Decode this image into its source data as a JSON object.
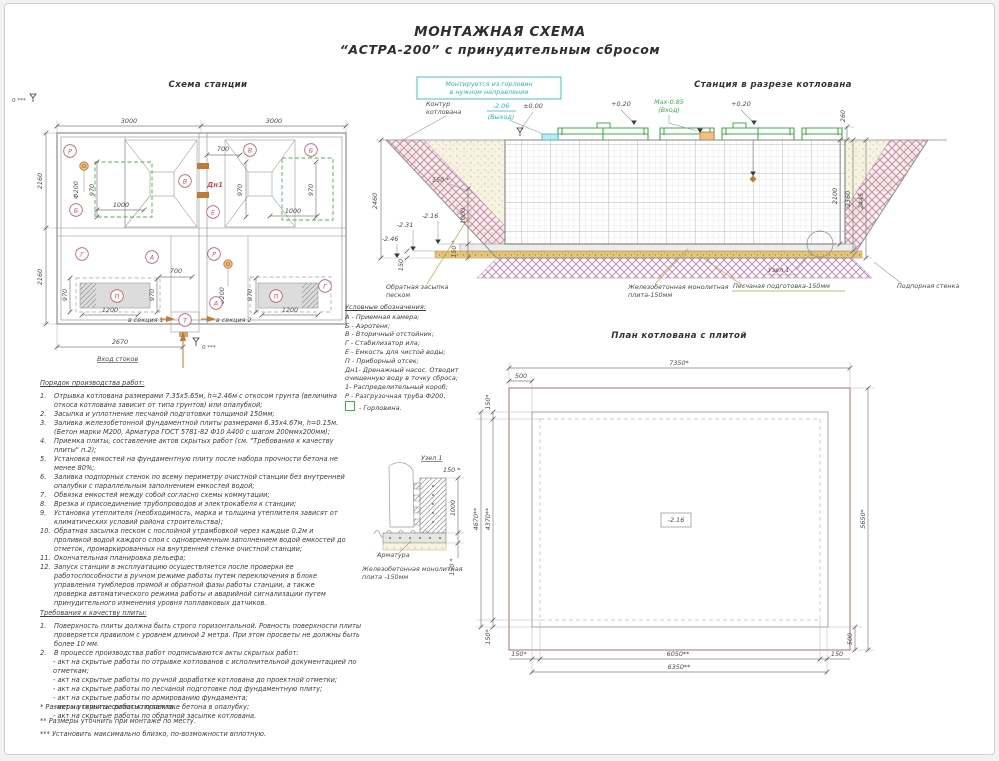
{
  "title": {
    "line1": "МОНТАЖНАЯ СХЕМА",
    "line2": "“АСТРА-200” с принудительным сбросом"
  },
  "scheme": {
    "title": "Схема станции",
    "d3000": "3000",
    "d2160": "2160",
    "d700": "700",
    "d970": "970",
    "d1000": "1000",
    "d1200": "1200",
    "d2670": "2670",
    "phi200": "Ф200",
    "zero": "0 ***",
    "dn1": "Дн1",
    "inlet": "Вход стоков",
    "sec1": "в секция 1",
    "sec2": "в секция 2",
    "L": {
      "r": "Р",
      "b": "Б",
      "v": "В",
      "e": "Е",
      "g": "Г",
      "a": "А",
      "p": "П",
      "t": "Т"
    }
  },
  "cross": {
    "title": "Станция в разрезе котлована",
    "mount1": "Монтируется из горловин",
    "mount2": "в нужном направлении",
    "contour1": "Контур",
    "contour2": "котлована",
    "out1": "-2.06",
    "out2": "(Выход)",
    "zero": "±0.00",
    "p020": "+0.20",
    "max1": "Мах-0.85",
    "max2": "(Вход)",
    "d260": "260",
    "d2445": "2445",
    "d2360": "2360",
    "d2100": "2100",
    "d2460": "2460",
    "e216": "-2.16",
    "e231": "-2.31",
    "e246": "-2.46",
    "d150s": "150 *",
    "d150": "150",
    "d1000": "1000",
    "backfill1": "Обратная засыпка",
    "backfill2": "песком",
    "slab1": "Железобетонная монолитная",
    "slab2": "плита-150мм",
    "sand": "Песчаная подготовка-150мм",
    "node": "Узел 1",
    "wall": "Подпорная стенка"
  },
  "legend": {
    "title": "Условные обозначения:",
    "items": [
      "А - Приемная камера;",
      "Б - Аэротенк;",
      "В - Вторичный отстойник;",
      "Г - Стабилизатор ила;",
      "Е - Емкость для чистой воды;",
      "П - Приборный отсек;",
      "Дн1- Дренажный насос. Отводит очищенную воду в точку сброса;",
      "1- Распределительный короб;",
      "Р - Разгрузочная труба Ф200,"
    ],
    "gorlovina": "- Горловина."
  },
  "plan": {
    "title": "План котлована с плитой",
    "d7350": "7350*",
    "d500": "500",
    "d150s": "150*",
    "d4670": "4670**",
    "d4370": "4370**",
    "d6050": "6050**",
    "d150": "150",
    "d6350": "6350**",
    "d5650": "5650*",
    "elev": "-2.16"
  },
  "node": {
    "title": "Узел 1",
    "d150s": "150 *",
    "d1000": "1000",
    "rebar": "Арматура",
    "slab1": "Железобетонная монолитная",
    "slab2": "плита -150мм"
  },
  "work": {
    "title": "Порядок производства работ:",
    "items": [
      {
        "n": "1.",
        "t": "Отрывка котлована размерами 7.35х5.65м, h=2.46м с откосом грунта (величина откоса котлована зависит от типа грунтов) или опалубкой;"
      },
      {
        "n": "2.",
        "t": "Засыпка и уплотнение песчаной подготовки толщиной 150мм;"
      },
      {
        "n": "3.",
        "t": "Заливка железобетонной фундаментной плиты размерами 6.35х4.67м, h=0.15м. (Бетон марки М200, Арматура ГОСТ 5781-82 Ф10 А400 с шагом 200ммх200мм);"
      },
      {
        "n": "4.",
        "t": "Приемка плиты, составление актов скрытых работ (см. \"Требования к качеству плиты\" п.2);"
      },
      {
        "n": "5.",
        "t": "Установка емкостей на фундаментную плиту после набора прочности бетона не менее 80%;"
      },
      {
        "n": "6.",
        "t": "Заливка подпорных стенок по всему периметру очистной станции без внутренней опалубки с параллельным заполнением емкостей водой;"
      },
      {
        "n": "7.",
        "t": "Обвязка емкостей между собой согласно схемы коммутации;"
      },
      {
        "n": "8.",
        "t": "Врезка и присоединение трубопроводов и электрокабеля к станции;"
      },
      {
        "n": "9.",
        "t": "Установка утеплителя (необходимость, марка и толщина утеплителя зависят от климатических условий района строительства);"
      },
      {
        "n": "10.",
        "t": "Обратная засыпка песком с послойной утрамбовкой через каждые 0.2м и проливкой водой каждого слоя с одновременным заполнением водой емкостей до отметок, промаркированных на внутренней стенке очистной станции;"
      },
      {
        "n": "11.",
        "t": "Окончательная планировка рельефа;"
      },
      {
        "n": "12.",
        "t": "Запуск станции в эксплуатацию осуществляется после проверки ее работоспособности в ручном режиме работы путем переключения в блоке управления тумблеров прямой и обратной фазы работы станции, а также проверка автоматического режима работы и аварийной сигнализации путем принудительного изменения уровня поплавковых датчиков."
      }
    ]
  },
  "quality": {
    "title": "Требования к качеству плиты:",
    "items": [
      {
        "n": "1.",
        "t": "Поверхность плиты должна быть строго горизонтальной. Ровность поверхности плиты проверяется правилом с уровнем длиной 2 метра. При этом просветы не должны быть более 10 мм."
      },
      {
        "n": "2.",
        "t": "В процессе производства работ подписываются акты скрытых работ:"
      }
    ],
    "acts": [
      "- акт на скрытые работы по отрывке котлованов с исполнительной документацией по отметкам;",
      "- акт на скрытые работы по ручной доработке котлована до проектной отметки;",
      "- акт на скрытые работы по песчаной подготовке под фундаментную плиту;",
      "- акт на скрытые работы по армированию фундамента;",
      "- акт на скрытые работы по заливке бетона в опалубку;",
      "- акт на скрытые работы по обратной засыпке котлована."
    ]
  },
  "footnotes": [
    "* Размеры уточнить согласно проекта.",
    "** Размеры уточнить при монтаже по месту.",
    "*** Установить максимально близко, по-возможности вплотную."
  ]
}
